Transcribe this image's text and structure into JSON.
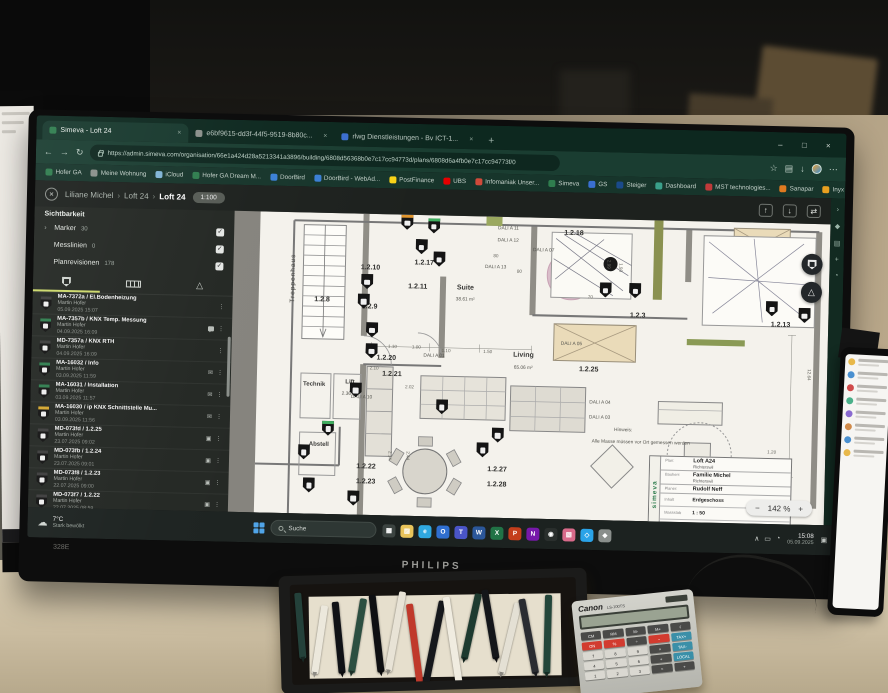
{
  "scene": {
    "monitor_brand": "PHILIPS",
    "monitor_model": "328E"
  },
  "left_monitor": {
    "time": "15:08",
    "date": "05.09.2025"
  },
  "browser": {
    "tabs": [
      {
        "title": "Simeva - Loft 24",
        "active": true,
        "color": "#2f7d4e"
      },
      {
        "title": "e6bf9615-dd3f-44f5-9519-8b80c...",
        "active": false,
        "color": "#8a8f8a"
      },
      {
        "title": "rlwg Dienstleistungen - Bv ICT-1...",
        "active": false,
        "color": "#3a6fd0"
      }
    ],
    "tab_close": "×",
    "new_tab": "+",
    "window_controls": [
      "–",
      "□",
      "×"
    ],
    "nav_icons": [
      "←",
      "→",
      "↻"
    ],
    "url": "https://admin.simeva.com/organisation/66e1a424d28a5213341a3896/building/6808d56368b0e7c17cc94773d/plans/6808d6a4fb0e7c17cc94773f/0",
    "addr_right_icons": [
      "☆",
      "▤",
      "↓"
    ],
    "menu_icon": "⋯",
    "side_icons": [
      "›",
      "◆",
      "▤",
      "+",
      "◔"
    ],
    "bookmarks": [
      {
        "label": "Hofer GA",
        "color": "#2f7d4e"
      },
      {
        "label": "Meine Wohnung",
        "color": "#8a8f8a"
      },
      {
        "label": "iCloud",
        "color": "#7fb3d5"
      },
      {
        "label": "Hofer GA Dream M...",
        "color": "#2f7d4e"
      },
      {
        "label": "DoorBird",
        "color": "#3a7fd5"
      },
      {
        "label": "DoorBird - WebAd...",
        "color": "#3a7fd5"
      },
      {
        "label": "PostFinance",
        "color": "#f8d317"
      },
      {
        "label": "UBS",
        "color": "#e60000"
      },
      {
        "label": "Infomaniak Unser...",
        "color": "#d04a3a"
      },
      {
        "label": "Simeva",
        "color": "#2f7d4e"
      },
      {
        "label": "GS",
        "color": "#3a6fd0"
      },
      {
        "label": "Steiger",
        "color": "#1a4a8a"
      },
      {
        "label": "Dashboard",
        "color": "#3aa08a"
      },
      {
        "label": "MST technologies...",
        "color": "#c03a3a"
      },
      {
        "label": "Sanapar",
        "color": "#e07a20"
      },
      {
        "label": "Inyx AG E-Shop",
        "color": "#e8a020"
      },
      {
        "label": "Allianz",
        "color": "#003781"
      },
      {
        "label": "Karten der Schweiz...",
        "color": "#d52b1e"
      },
      {
        "label": "SwissTransfer.com -...",
        "color": "#707070"
      },
      {
        "label": "Citrix Portal",
        "color": "#2b6fb3"
      },
      {
        "label": "My Cloud",
        "color": "#3aa0d8"
      }
    ]
  },
  "app": {
    "close_icon": "×",
    "breadcrumb": [
      "Liliane Michel",
      "Loft 24",
      "Loft 24"
    ],
    "breadcrumb_sep": "›",
    "scale_badge": "1:100",
    "header_icons": [
      "↑",
      "↓",
      "⇄"
    ],
    "sidebar": {
      "visibility_title": "Sichtbarkeit",
      "chevron": "›",
      "check": "✓",
      "layers": [
        {
          "label": "Marker",
          "count": "30"
        },
        {
          "label": "Messlinien",
          "count": "0"
        },
        {
          "label": "Planrevisionen",
          "count": "178"
        }
      ],
      "items": [
        {
          "id": "MA-7372a / El.Bodenheizung",
          "author": "Martin Hofer",
          "date": "05.09.2025 15:07",
          "top": "#3d3d3d",
          "badges": [
            "kebab"
          ]
        },
        {
          "id": "MA-7357b / KNX Temp. Messung",
          "author": "Martin Hofer",
          "date": "04.09.2025 16:09",
          "top": "#2f7d4e",
          "badges": [
            "chat",
            "kebab"
          ]
        },
        {
          "id": "MD-7357a / KNX RTH",
          "author": "Martin Hofer",
          "date": "04.09.2025 16:09",
          "top": "#3d3d3d",
          "badges": [
            "kebab"
          ]
        },
        {
          "id": "MA-16032 / Info",
          "author": "Martin Hofer",
          "date": "03.09.2025 11:59",
          "top": "#2f7d4e",
          "badges": [
            "mail",
            "kebab"
          ]
        },
        {
          "id": "MA-16031 / Installation",
          "author": "Martin Hofer",
          "date": "03.09.2025 11:57",
          "top": "#2f7d4e",
          "badges": [
            "mail",
            "kebab"
          ]
        },
        {
          "id": "MA-16030 / ip KNX Schnittstelle Mu...",
          "author": "Martin Hofer",
          "date": "03.09.2025 11:56",
          "top": "#d3a62f",
          "badges": [
            "mail",
            "kebab"
          ]
        },
        {
          "id": "MD-073fd / 1.2.25",
          "author": "Martin Hofer",
          "date": "23.07.2025 09:02",
          "top": "#3d3d3d",
          "badges": [
            "cam",
            "kebab"
          ]
        },
        {
          "id": "MD-073fb / 1.2.24",
          "author": "Martin Hofer",
          "date": "23.07.2025 09:01",
          "top": "#3d3d3d",
          "badges": [
            "cam",
            "kebab"
          ]
        },
        {
          "id": "MD-073f8 / 1.2.23",
          "author": "Martin Hofer",
          "date": "22.07.2025 09:00",
          "top": "#3d3d3d",
          "badges": [
            "cam",
            "kebab"
          ]
        },
        {
          "id": "MD-073f7 / 1.2.22",
          "author": "Martin Hofer",
          "date": "22.07.2025 08:59",
          "top": "#3d3d3d",
          "badges": [
            "cam",
            "kebab"
          ]
        },
        {
          "id": "MD-073f5 / 1.2.21",
          "author": "Martin Hofer",
          "date": "22.07.2025 08:58",
          "top": "#3d3d3d",
          "badges": [
            "cam",
            "kebab"
          ]
        },
        {
          "id": "MD-073f3 / 1.2.20",
          "author": "Martin Hofer",
          "date": "22.07.2025 08:57",
          "top": "#3d3d3d",
          "badges": [
            "cam",
            "kebab"
          ]
        }
      ]
    },
    "plan": {
      "zoom": {
        "minus": "−",
        "value": "142 %",
        "plus": "+"
      },
      "triangle_icon": "△",
      "labels": [
        {
          "t": "Treppenhaus",
          "x": 10,
          "y": 22,
          "c": "vert"
        },
        {
          "t": "1.2.8",
          "x": 15,
          "y": 29,
          "c": "num"
        },
        {
          "t": "1.2.10",
          "x": 23,
          "y": 18,
          "c": "num"
        },
        {
          "t": "1.2.9",
          "x": 23,
          "y": 31,
          "c": "num"
        },
        {
          "t": "1.2.17",
          "x": 32,
          "y": 16,
          "c": "num"
        },
        {
          "t": "1.2.11",
          "x": 31,
          "y": 24,
          "c": "num"
        },
        {
          "t": "1.2.18",
          "x": 57,
          "y": 5,
          "c": "num"
        },
        {
          "t": "1.2.3",
          "x": 68,
          "y": 32,
          "c": "num"
        },
        {
          "t": "1.2.13",
          "x": 92,
          "y": 34,
          "c": "num"
        },
        {
          "t": "1.2.20",
          "x": 26,
          "y": 48,
          "c": "num"
        },
        {
          "t": "1.2.21",
          "x": 27,
          "y": 53,
          "c": "num"
        },
        {
          "t": "1.2.25",
          "x": 60,
          "y": 50,
          "c": "num"
        },
        {
          "t": "1.2.22",
          "x": 23,
          "y": 84,
          "c": "num"
        },
        {
          "t": "1.2.23",
          "x": 23,
          "y": 89,
          "c": "num"
        },
        {
          "t": "1.2.27",
          "x": 45,
          "y": 84,
          "c": "num"
        },
        {
          "t": "1.2.28",
          "x": 45,
          "y": 89,
          "c": "num"
        },
        {
          "t": "Suite",
          "x": 39,
          "y": 24,
          "c": "room"
        },
        {
          "t": "38.61 m²",
          "x": 39,
          "y": 28,
          "c": "dali"
        },
        {
          "t": "Living",
          "x": 49,
          "y": 46,
          "c": "room"
        },
        {
          "t": "65.06 m²",
          "x": 49,
          "y": 50,
          "c": "dali"
        },
        {
          "t": "Technik",
          "x": 14,
          "y": 57,
          "c": "room2"
        },
        {
          "t": "Lift",
          "x": 20,
          "y": 56,
          "c": "room2"
        },
        {
          "t": "2.36 m²",
          "x": 20,
          "y": 60,
          "c": "dali"
        },
        {
          "t": "Abstell",
          "x": 15,
          "y": 77,
          "c": "room2"
        },
        {
          "t": "DALI A 01",
          "x": 34,
          "y": 47,
          "c": "dali"
        },
        {
          "t": "DALI A 03",
          "x": 62,
          "y": 66,
          "c": "dali"
        },
        {
          "t": "DALI A 04",
          "x": 62,
          "y": 61,
          "c": "dali"
        },
        {
          "t": "DALI A 05",
          "x": 57,
          "y": 42,
          "c": "dali"
        },
        {
          "t": "DALI A 07",
          "x": 52,
          "y": 11,
          "c": "dali"
        },
        {
          "t": "DALI A 10",
          "x": 22,
          "y": 61,
          "c": "dali"
        },
        {
          "t": "DALI A 11",
          "x": 46,
          "y": 4,
          "c": "dali"
        },
        {
          "t": "DALI A 12",
          "x": 46,
          "y": 8,
          "c": "dali"
        },
        {
          "t": "DALI A 13",
          "x": 44,
          "y": 17,
          "c": "dali"
        },
        {
          "t": "1.10",
          "x": 27,
          "y": 44,
          "c": "dim"
        },
        {
          "t": "1.00",
          "x": 31,
          "y": 44,
          "c": "dim"
        },
        {
          "t": "1.10",
          "x": 36,
          "y": 45,
          "c": "dim"
        },
        {
          "t": "1.50",
          "x": 43,
          "y": 45,
          "c": "dim"
        },
        {
          "t": "2.10",
          "x": 24,
          "y": 51,
          "c": "dim"
        },
        {
          "t": "2.02",
          "x": 30,
          "y": 57,
          "c": "dim"
        },
        {
          "t": "80",
          "x": 48,
          "y": 18,
          "c": "dim"
        },
        {
          "t": "70",
          "x": 60,
          "y": 26,
          "c": "dim"
        },
        {
          "t": "80",
          "x": 44,
          "y": 13,
          "c": "dim"
        },
        {
          "t": "2.99",
          "x": 63,
          "y": 15,
          "c": "dimv"
        },
        {
          "t": "1.90",
          "x": 65,
          "y": 16,
          "c": "dimv"
        },
        {
          "t": "2.14",
          "x": 27,
          "y": 80,
          "c": "dimv"
        },
        {
          "t": "2.44",
          "x": 30,
          "y": 80,
          "c": "dimv"
        },
        {
          "t": "1.20",
          "x": 91,
          "y": 76,
          "c": "dim"
        },
        {
          "t": "12.64",
          "x": 97,
          "y": 50,
          "c": "dimv"
        },
        {
          "t": "Hinweis:",
          "x": 66,
          "y": 70,
          "c": "note"
        },
        {
          "t": "Alle Masse müssen vor Ort gemessen werden",
          "x": 69,
          "y": 74,
          "c": "note"
        }
      ],
      "markers": [
        {
          "x": 29,
          "y": 1,
          "top": "#e0952e"
        },
        {
          "x": 33.5,
          "y": 2,
          "top": "#3fae5f"
        },
        {
          "x": 31.5,
          "y": 9
        },
        {
          "x": 22.5,
          "y": 21
        },
        {
          "x": 22,
          "y": 27.5
        },
        {
          "x": 34.5,
          "y": 13
        },
        {
          "x": 23.5,
          "y": 37
        },
        {
          "x": 23.5,
          "y": 44
        },
        {
          "x": 21,
          "y": 57
        },
        {
          "x": 16.5,
          "y": 70,
          "top": "#3fae5f"
        },
        {
          "x": 12.5,
          "y": 78
        },
        {
          "x": 13.5,
          "y": 89
        },
        {
          "x": 21,
          "y": 93
        },
        {
          "x": 35.5,
          "y": 62
        },
        {
          "x": 45,
          "y": 71
        },
        {
          "x": 42.5,
          "y": 76
        },
        {
          "x": 62.5,
          "y": 22
        },
        {
          "x": 67.5,
          "y": 22
        },
        {
          "x": 90.5,
          "y": 27
        },
        {
          "x": 96,
          "y": 29
        }
      ],
      "title_block": {
        "brand": "simeva",
        "fields": [
          {
            "label": "Plan:",
            "value": "Loft A24",
            "sub": "Richterswil"
          },
          {
            "label": "Bauherr:",
            "value": "Familie Michel",
            "sub": "Richterswil"
          },
          {
            "label": "Planer:",
            "value": "Rudolf Neff",
            "sub": ""
          }
        ],
        "table": [
          [
            "Inhalt",
            "Erdgeschoss"
          ],
          [
            "Massstab",
            "1 : 50"
          ],
          [
            "Datum",
            "14.07.2005"
          ]
        ]
      }
    }
  },
  "taskbar": {
    "weather_icon": "☁",
    "weather_temp": "7°C",
    "weather_desc": "Stark bewölkt",
    "search_label": "Suche",
    "icons": [
      {
        "n": "task-view-icon",
        "b": "#3c4441",
        "g": "▦"
      },
      {
        "n": "file-explorer-icon",
        "b": "#e8c35a",
        "g": "▨"
      },
      {
        "n": "edge-icon",
        "b": "#2fa8e0",
        "g": "e"
      },
      {
        "n": "outlook-icon",
        "b": "#2f6fd0",
        "g": "O"
      },
      {
        "n": "teams-icon",
        "b": "#4a55c7",
        "g": "T"
      },
      {
        "n": "word-icon",
        "b": "#2b579a",
        "g": "W"
      },
      {
        "n": "excel-icon",
        "b": "#217346",
        "g": "X"
      },
      {
        "n": "powerpoint-icon",
        "b": "#c43e1c",
        "g": "P"
      },
      {
        "n": "onenote-icon",
        "b": "#7719aa",
        "g": "N"
      },
      {
        "n": "photos-icon",
        "b": "#2a2f2d",
        "g": "◉"
      },
      {
        "n": "paint-icon",
        "b": "#d86a8a",
        "g": "▧"
      },
      {
        "n": "vscode-icon",
        "b": "#2aa3e8",
        "g": "◇"
      },
      {
        "n": "settings-icon",
        "b": "#8a8f8c",
        "g": "◆"
      }
    ],
    "tray_icons": [
      "∧",
      "▭",
      "◔"
    ],
    "time": "15:08",
    "date": "05.09.2025",
    "notif_icon": "▣"
  },
  "desk": {
    "pen_colors": [
      "#24413a",
      "#ece8dc",
      "#101216",
      "#2c4f41",
      "#0e0f12",
      "#e8e3d6",
      "#c0392b",
      "#16181c",
      "#f0ece0",
      "#1d3a2f",
      "#14161a",
      "#e4e0d4",
      "#2a2c31",
      "#23463a"
    ],
    "calculator": {
      "brand": "Canon",
      "model": "LS-100TS",
      "rows": [
        [
          {
            "t": "CM",
            "c": "dark"
          },
          {
            "t": "RM",
            "c": "dark"
          },
          {
            "t": "M-",
            "c": "dark"
          },
          {
            "t": "M+",
            "c": "dark"
          },
          {
            "t": "√",
            "c": "dark"
          }
        ],
        [
          {
            "t": "ON",
            "c": "red"
          },
          {
            "t": "%",
            "c": "red"
          },
          {
            "t": "÷",
            "c": "dark"
          },
          {
            "t": "−",
            "c": "red"
          },
          {
            "t": "TAX+",
            "c": "blue"
          }
        ],
        [
          {
            "t": "7"
          },
          {
            "t": "8"
          },
          {
            "t": "9"
          },
          {
            "t": "×",
            "c": "dark"
          },
          {
            "t": "TAX-",
            "c": "blue"
          }
        ],
        [
          {
            "t": "4"
          },
          {
            "t": "5"
          },
          {
            "t": "6"
          },
          {
            "t": "+",
            "c": "dark"
          },
          {
            "t": "LOCAL",
            "c": "blue"
          }
        ],
        [
          {
            "t": "1"
          },
          {
            "t": "2"
          },
          {
            "t": "3"
          },
          {
            "t": "=",
            "c": "dark"
          },
          {
            "t": "+",
            "c": "dark"
          }
        ]
      ]
    }
  },
  "tablet": {
    "row_colors": [
      "#e8b84a",
      "#4a90d0",
      "#d04a4a",
      "#4ab08a",
      "#8a6ad0",
      "#d08a4a",
      "#4a90d0",
      "#e8b84a"
    ]
  }
}
